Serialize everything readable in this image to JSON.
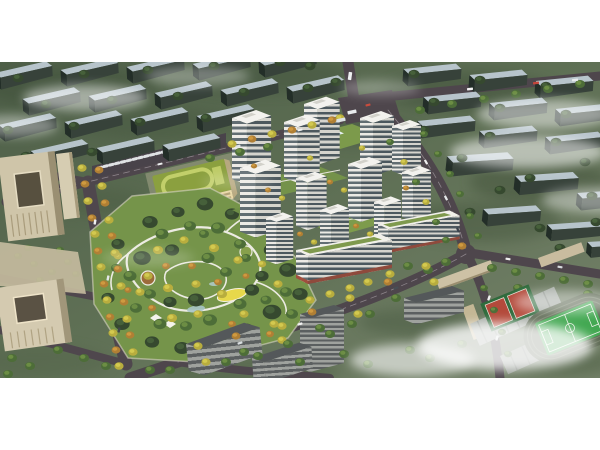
{
  "image": {
    "type": "architectural-aerial-rendering",
    "description": "Aerial bird's-eye rendering of a residential development masterplan: a cluster of white high-rise apartment towers around landscaped green courtyards with a rooftop pool deck, a large central park with winding white paths, a bright yellow playground and small ponds, a kindergarten with a green roof loop, beige office towers on the left, perimeter roads lined with yellow and orange street trees, low-rise blue-roofed context blocks on the top and right, a school sports field with running track and red basketball courts at lower right, and soft white clouds drifting over the scene. White bands frame the photo at top and bottom."
  },
  "scene": {
    "regions": [
      "surrounding low-rise context blocks",
      "road network with intersections and vehicles",
      "tree-lined boulevard",
      "office towers and plaza",
      "kindergarten with green roof",
      "central landscaped park",
      "residential tower cluster",
      "commercial street frontage",
      "gray mid-rise context buildings",
      "school campus with sports field and basketball courts",
      "clouds and fog"
    ]
  },
  "palette": {
    "background_white": "#ffffff",
    "terrain_green_dark": "#46573f",
    "terrain_green": "#5f7055",
    "terrain_green_light": "#75826a",
    "context_roof_blue": "#b7c4cb",
    "context_side_dark": "#37423a",
    "road_asphalt": "#4e464c",
    "tower_white": "#f3f2ee",
    "tower_window_band": "#616d72",
    "office_beige": "#cfc5a9",
    "school_roof_green": "#8ba03f",
    "school_track_light_green": "#c2cf6a",
    "park_green": "#75944a",
    "tree_yellow": "#d3c94f",
    "tree_orange": "#cf9a40",
    "path_white": "#ecebe2",
    "playground_yellow": "#e7d84b",
    "pitch_green": "#43a852",
    "court_red": "#b34a3b",
    "commercial_base_red": "#a04f3e",
    "cloud_white": "#ffffff"
  }
}
